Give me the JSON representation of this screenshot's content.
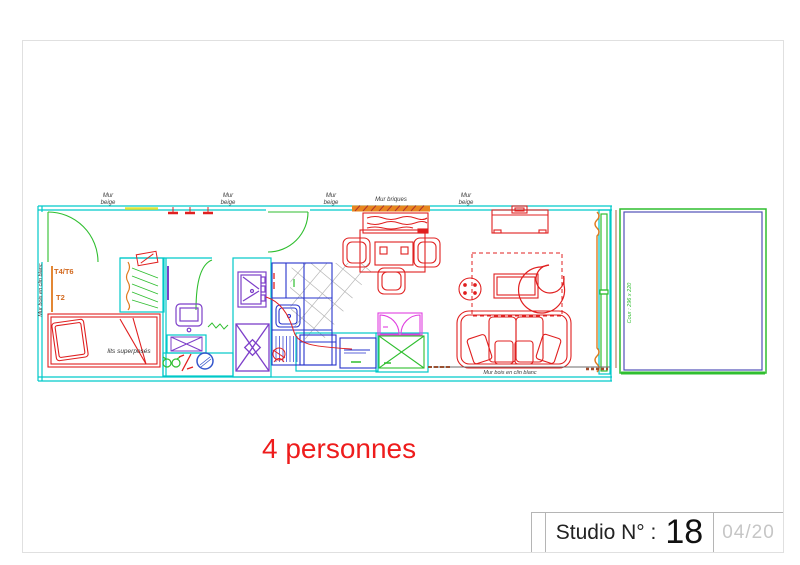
{
  "sheet": {
    "caption": "4 personnes",
    "title_block": {
      "label": "Studio N° :",
      "number": "18",
      "page_ref": "04/20"
    }
  },
  "plan": {
    "top_wall_labels": [
      "Mur\nbeige",
      "Mur\nbeige",
      "Mur\nbeige",
      "Mur briques",
      "Mur\nbeige"
    ],
    "left_wall_label": "Mur bois en clin blanc",
    "bottom_wall_label": "Mur bois en clin blanc",
    "unit_labels": {
      "primary": "T4/T6",
      "secondary": "T2"
    },
    "bed_label": "lits superposés",
    "courtyard_label": "Cour : 296 x 220"
  },
  "colors": {
    "walls": "#00c9c9",
    "doors_windows": "#2fbe2f",
    "furniture": "#e02020",
    "fixtures": "#7d3fc9",
    "kitchen": "#2633cc",
    "wood": "#e07a1e",
    "caption": "#ee1c1c"
  }
}
